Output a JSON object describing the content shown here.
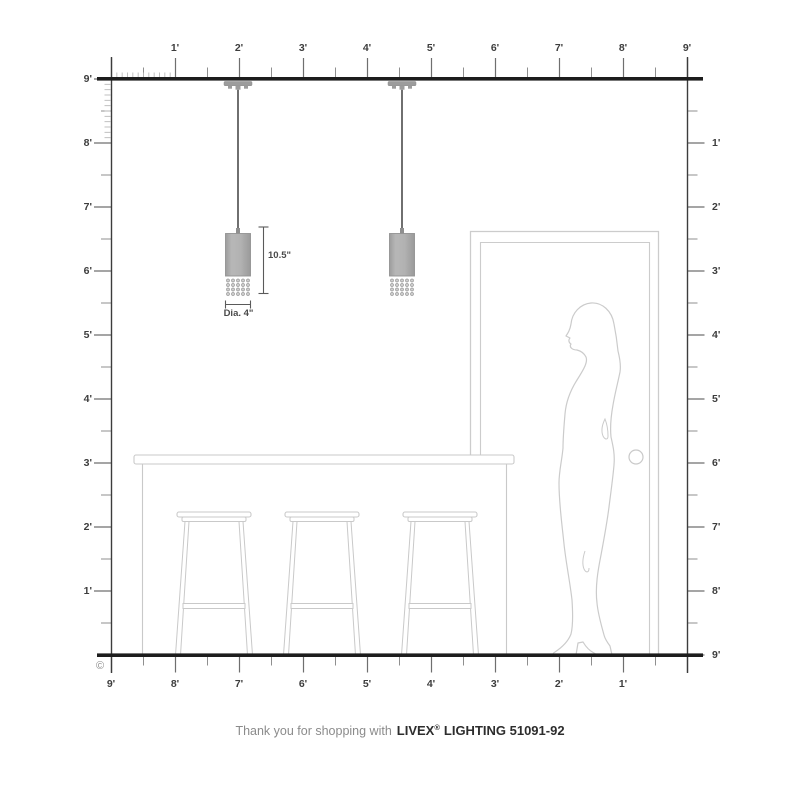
{
  "caption": {
    "prefix": "Thank you for shopping with",
    "brand": "LIVEX",
    "reg": "®",
    "suffix": "LIGHTING 51091-92"
  },
  "copyright_symbol": "©",
  "rulers": {
    "top": {
      "labels": [
        "1'",
        "2'",
        "3'",
        "4'",
        "5'",
        "6'",
        "7'",
        "8'",
        "9'"
      ]
    },
    "left": {
      "labels": [
        "9'",
        "8'",
        "7'",
        "6'",
        "5'",
        "4'",
        "3'",
        "2'",
        "1'"
      ]
    },
    "right": {
      "labels": [
        "1'",
        "2'",
        "3'",
        "4'",
        "5'",
        "6'",
        "7'",
        "8'",
        "9'"
      ]
    },
    "bottom": {
      "labels": [
        "9'",
        "8'",
        "7'",
        "6'",
        "5'",
        "4'",
        "3'",
        "2'",
        "1'"
      ]
    }
  },
  "annotations": {
    "fixture_height": "10.5\"",
    "fixture_diameter": "Dia. 4\""
  },
  "colors": {
    "structure_line": "#1d1d1d",
    "tick_major": "#6f6f6f",
    "furniture_line": "#cbcbcb",
    "pendant_gray": "#ababab",
    "cord": "#565656"
  }
}
